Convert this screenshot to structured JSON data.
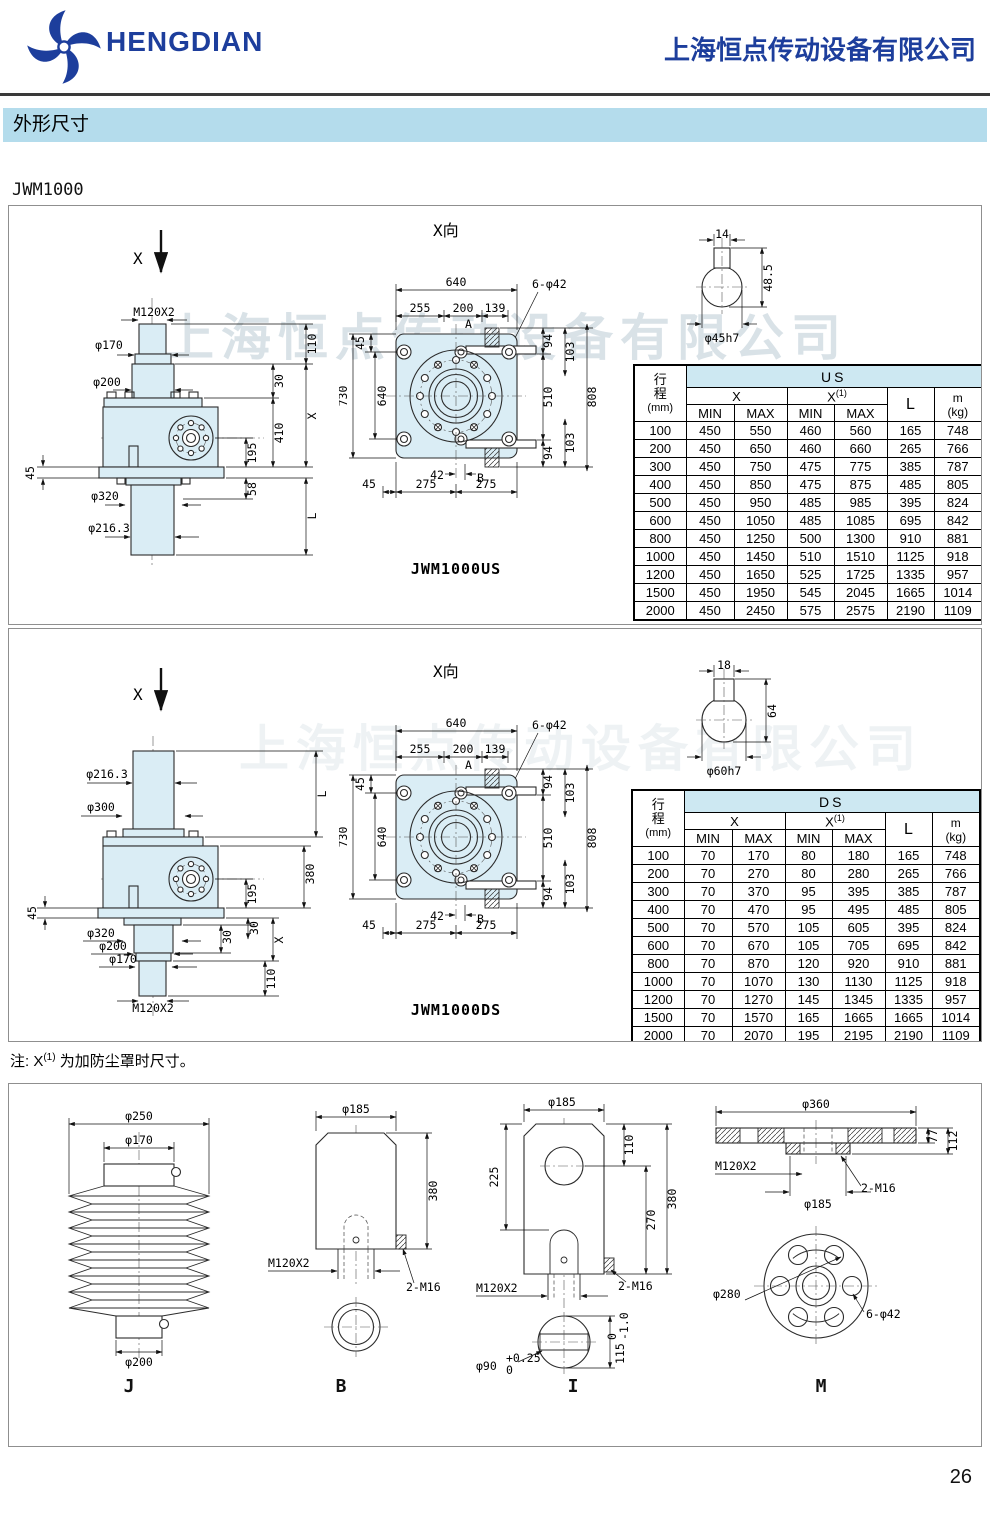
{
  "header": {
    "brand": "HENGDIAN",
    "company": "上海恒点传动设备有限公司",
    "logo": "pinwheel-logo"
  },
  "colors": {
    "brand_blue": "#1d3e9c",
    "section_bar": "#b4dcec",
    "drawing_fill": "#daedf5",
    "table_group_bg": "#cde8f2"
  },
  "section_title": "外形尺寸",
  "model": "JWM1000",
  "watermark": "上海恒点传动设备有限公司",
  "note": {
    "prefix": "注: X",
    "sup": "(1)",
    "suffix": " 为加防尘罩时尺寸。"
  },
  "page_number": "26",
  "us": {
    "side": {
      "x": "X",
      "m120": "M120X2",
      "d170": "φ170",
      "d200": "φ200",
      "d45": "45",
      "d320": "φ320",
      "d216": "φ216.3",
      "r110": "110",
      "r30": "30",
      "rx": "X",
      "r410": "410",
      "r195": "195",
      "r58": "58",
      "rl": "L"
    },
    "front": {
      "title": "X向",
      "d640": "640",
      "d255": "255",
      "d200": "200",
      "d139": "139",
      "holes": "6-φ42",
      "a": "A",
      "b": "B",
      "l45": "45",
      "l730": "730",
      "l640": "640",
      "r94t": "94",
      "r103t": "103",
      "r510": "510",
      "r808": "808",
      "r94b": "94",
      "r103b": "103",
      "b42": "42",
      "b275l": "275",
      "b275r": "275",
      "b45": "45",
      "caption": "JWM1000US"
    },
    "shaft": {
      "w": "14",
      "h": "48.5",
      "d": "φ45h7"
    },
    "table": {
      "c1a": "行",
      "c1b": "程",
      "c1c": "(mm)",
      "group": "US",
      "x": "X",
      "x1": "X",
      "x1s": "(1)",
      "min": "MIN",
      "max": "MAX",
      "l": "L",
      "m": "m",
      "kg": "(kg)",
      "rows": [
        [
          "100",
          "450",
          "550",
          "460",
          "560",
          "165",
          "748"
        ],
        [
          "200",
          "450",
          "650",
          "460",
          "660",
          "265",
          "766"
        ],
        [
          "300",
          "450",
          "750",
          "475",
          "775",
          "385",
          "787"
        ],
        [
          "400",
          "450",
          "850",
          "475",
          "875",
          "485",
          "805"
        ],
        [
          "500",
          "450",
          "950",
          "485",
          "985",
          "395",
          "824"
        ],
        [
          "600",
          "450",
          "1050",
          "485",
          "1085",
          "695",
          "842"
        ],
        [
          "800",
          "450",
          "1250",
          "500",
          "1300",
          "910",
          "881"
        ],
        [
          "1000",
          "450",
          "1450",
          "510",
          "1510",
          "1125",
          "918"
        ],
        [
          "1200",
          "450",
          "1650",
          "525",
          "1725",
          "1335",
          "957"
        ],
        [
          "1500",
          "450",
          "1950",
          "545",
          "2045",
          "1665",
          "1014"
        ],
        [
          "2000",
          "450",
          "2450",
          "575",
          "2575",
          "2190",
          "1109"
        ]
      ]
    }
  },
  "ds": {
    "side": {
      "x": "X",
      "d216": "φ216.3",
      "d300": "φ300",
      "d45": "45",
      "d320": "φ320",
      "d200": "φ200",
      "d170": "φ170",
      "m120": "M120X2",
      "rl": "L",
      "r380": "380",
      "r195": "195",
      "r30a": "30",
      "r30b": "30",
      "rx": "X",
      "r110": "110"
    },
    "front": {
      "title": "X向",
      "d640": "640",
      "d255": "255",
      "d200": "200",
      "d139": "139",
      "holes": "6-φ42",
      "a": "A",
      "b": "B",
      "l45": "45",
      "l730": "730",
      "l640": "640",
      "r94t": "94",
      "r103t": "103",
      "r510": "510",
      "r808": "808",
      "r94b": "94",
      "r103b": "103",
      "b42": "42",
      "b275l": "275",
      "b275r": "275",
      "b45": "45",
      "caption": "JWM1000DS"
    },
    "shaft": {
      "w": "18",
      "h": "64",
      "d": "φ60h7"
    },
    "table": {
      "c1a": "行",
      "c1b": "程",
      "c1c": "(mm)",
      "group": "DS",
      "x": "X",
      "x1": "X",
      "x1s": "(1)",
      "min": "MIN",
      "max": "MAX",
      "l": "L",
      "m": "m",
      "kg": "(kg)",
      "rows": [
        [
          "100",
          "70",
          "170",
          "80",
          "180",
          "165",
          "748"
        ],
        [
          "200",
          "70",
          "270",
          "80",
          "280",
          "265",
          "766"
        ],
        [
          "300",
          "70",
          "370",
          "95",
          "395",
          "385",
          "787"
        ],
        [
          "400",
          "70",
          "470",
          "95",
          "495",
          "485",
          "805"
        ],
        [
          "500",
          "70",
          "570",
          "105",
          "605",
          "395",
          "824"
        ],
        [
          "600",
          "70",
          "670",
          "105",
          "705",
          "695",
          "842"
        ],
        [
          "800",
          "70",
          "870",
          "120",
          "920",
          "910",
          "881"
        ],
        [
          "1000",
          "70",
          "1070",
          "130",
          "1130",
          "1125",
          "918"
        ],
        [
          "1200",
          "70",
          "1270",
          "145",
          "1345",
          "1335",
          "957"
        ],
        [
          "1500",
          "70",
          "1570",
          "165",
          "1665",
          "1665",
          "1014"
        ],
        [
          "2000",
          "70",
          "2070",
          "195",
          "2195",
          "2190",
          "1109"
        ]
      ]
    }
  },
  "ends": {
    "j": {
      "cap": "J",
      "d250": "φ250",
      "d170": "φ170",
      "d200": "φ200"
    },
    "b": {
      "cap": "B",
      "d185": "φ185",
      "d380": "380",
      "m120": "M120X2",
      "m16": "2-M16"
    },
    "i": {
      "cap": "I",
      "d185": "φ185",
      "r110": "110",
      "l225": "225",
      "r270": "270",
      "r380": "380",
      "m120": "M120X2",
      "m16": "2-M16",
      "d90": "φ90",
      "d90u": "+0.25",
      "d90l": "0",
      "d115": "115",
      "d115u": "0",
      "d115l": "-1.0"
    },
    "m": {
      "cap": "M",
      "d360": "φ360",
      "r77": "77",
      "r112": "112",
      "m120": "M120X2",
      "m16": "2-M16",
      "d185": "φ185",
      "d280": "φ280",
      "holes": "6-φ42"
    }
  }
}
